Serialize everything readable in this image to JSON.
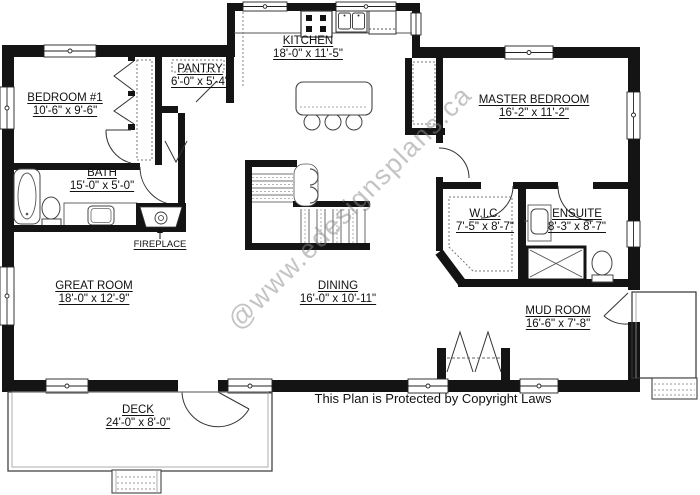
{
  "watermark": "@www.edesignsplans.ca",
  "copyright_notice": "This Plan is Protected by Copyright Laws",
  "annotations": {
    "fireplace": "FIREPLACE"
  },
  "rooms": {
    "bedroom1": {
      "name": "BEDROOM #1",
      "dims": "10'-6\" x 9'-6\""
    },
    "bath": {
      "name": "BATH",
      "dims": "15'-0\" x 5'-0\""
    },
    "pantry": {
      "name": "PANTRY",
      "dims": "6'-0\" x 5'-4\""
    },
    "kitchen": {
      "name": "KITCHEN",
      "dims": "18'-0\" x 11'-5\""
    },
    "master_bedroom": {
      "name": "MASTER BEDROOM",
      "dims": "16'-2\" x 11'-2\""
    },
    "wic": {
      "name": "W.I.C.",
      "dims": "7'-5\" x 8'-7\""
    },
    "ensuite": {
      "name": "ENSUITE",
      "dims": "8'-3\" x 8'-7\""
    },
    "great_room": {
      "name": "GREAT ROOM",
      "dims": "18'-0\" x 12'-9\""
    },
    "dining": {
      "name": "DINING",
      "dims": "16'-0\" x 10'-11\""
    },
    "mud_room": {
      "name": "MUD ROOM",
      "dims": "16'-6\" x 7'-8\""
    },
    "deck": {
      "name": "DECK",
      "dims": "24'-0\" x 8'-0\""
    }
  }
}
